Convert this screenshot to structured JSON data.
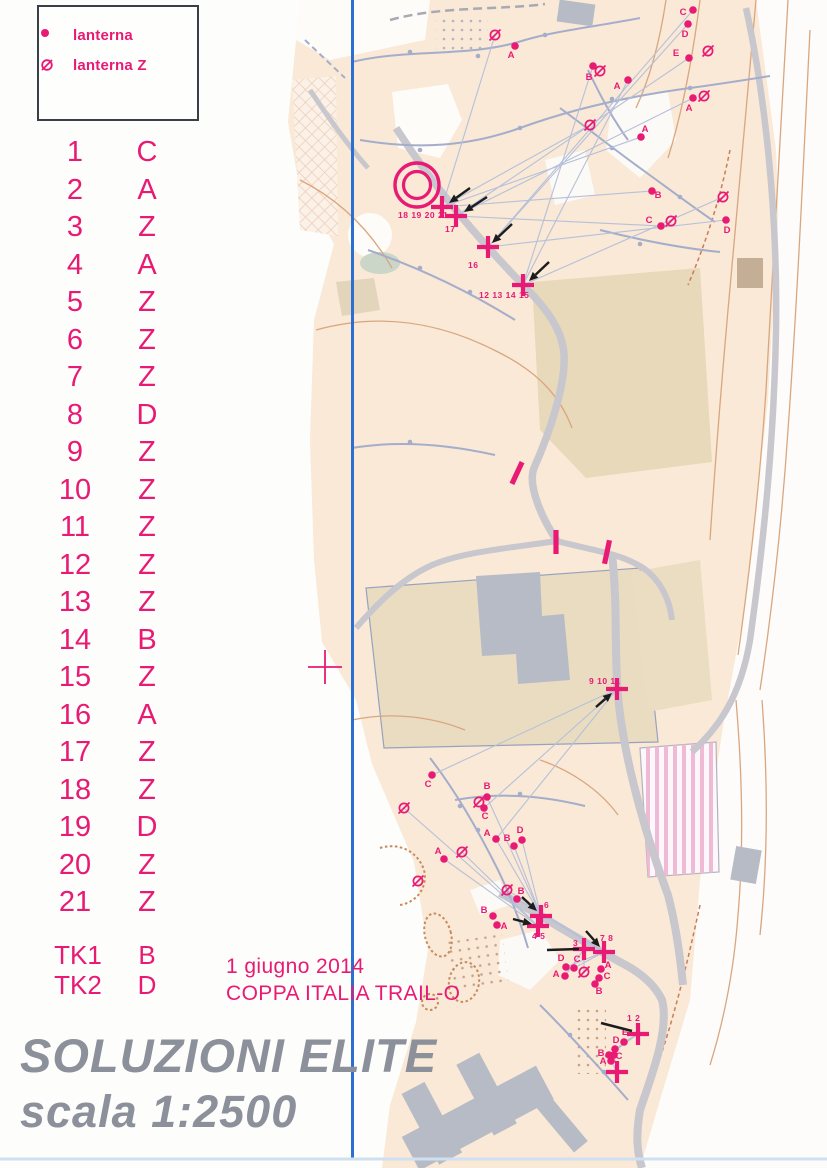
{
  "meta": {
    "event_date": "1 giugno 2014",
    "event_name": "COPPA ITALIA TRAIL-O",
    "title_line1": "SOLUZIONI ELITE",
    "title_line2": "scala 1:2500"
  },
  "colors": {
    "magenta_overprint": "#e81a74",
    "title_gray": "#8b909a",
    "fold_line_blue": "#2b6fd0",
    "map_cream": "#f9e9d6",
    "contour_brown": "#d9a67f",
    "trail_bluegray": "#a4adcb",
    "road_gray": "#c7c7cd",
    "building_gray": "#b6bbc6"
  },
  "legend": {
    "items": [
      {
        "symbol": "lanterna-dot",
        "label": "lanterna"
      },
      {
        "symbol": "lanterna-z",
        "label": "lanterna Z"
      }
    ]
  },
  "solutions": {
    "controls": [
      {
        "n": "1",
        "a": "C"
      },
      {
        "n": "2",
        "a": "A"
      },
      {
        "n": "3",
        "a": "Z"
      },
      {
        "n": "4",
        "a": "A"
      },
      {
        "n": "5",
        "a": "Z"
      },
      {
        "n": "6",
        "a": "Z"
      },
      {
        "n": "7",
        "a": "Z"
      },
      {
        "n": "8",
        "a": "D"
      },
      {
        "n": "9",
        "a": "Z"
      },
      {
        "n": "10",
        "a": "Z"
      },
      {
        "n": "11",
        "a": "Z"
      },
      {
        "n": "12",
        "a": "Z"
      },
      {
        "n": "13",
        "a": "Z"
      },
      {
        "n": "14",
        "a": "B"
      },
      {
        "n": "15",
        "a": "Z"
      },
      {
        "n": "16",
        "a": "A"
      },
      {
        "n": "17",
        "a": "Z"
      },
      {
        "n": "18",
        "a": "Z"
      },
      {
        "n": "19",
        "a": "D"
      },
      {
        "n": "20",
        "a": "Z"
      },
      {
        "n": "21",
        "a": "Z"
      }
    ],
    "timed": [
      {
        "n": "TK1",
        "a": "B"
      },
      {
        "n": "TK2",
        "a": "D"
      }
    ]
  },
  "map_overlay": {
    "start_circle": {
      "x": 417,
      "y": 185,
      "r_outer": 22,
      "r_inner": 13.5
    },
    "register_cross": {
      "x": 325,
      "y": 667
    },
    "crosses": [
      {
        "x": 442,
        "y": 207,
        "label": "18 19 20 21",
        "lx": 398,
        "ly": 218
      },
      {
        "x": 456,
        "y": 216,
        "label": "17",
        "lx": 445,
        "ly": 232
      },
      {
        "x": 488,
        "y": 247,
        "label": "16",
        "lx": 468,
        "ly": 268
      },
      {
        "x": 523,
        "y": 285,
        "label": "12 13 14 15",
        "lx": 479,
        "ly": 298
      },
      {
        "x": 617,
        "y": 689,
        "label": "9 10 11",
        "lx": 589,
        "ly": 684
      },
      {
        "x": 541,
        "y": 916,
        "label": "6",
        "lx": 544,
        "ly": 908
      },
      {
        "x": 538,
        "y": 926,
        "label": "4 5",
        "lx": 532,
        "ly": 939
      },
      {
        "x": 584,
        "y": 949,
        "label": "3",
        "lx": 573,
        "ly": 946
      },
      {
        "x": 604,
        "y": 952,
        "label": "7 8",
        "lx": 600,
        "ly": 941
      },
      {
        "x": 638,
        "y": 1034,
        "label": "1 2",
        "lx": 627,
        "ly": 1021
      },
      {
        "x": 617,
        "y": 1072,
        "label": ""
      }
    ],
    "points": [
      {
        "x": 693,
        "y": 10,
        "l": "C",
        "dx": -10,
        "dy": 5
      },
      {
        "x": 688,
        "y": 24,
        "l": "D",
        "dx": -3,
        "dy": 13
      },
      {
        "x": 689,
        "y": 58,
        "l": "E",
        "dx": -13,
        "dy": -2,
        "zx": 708,
        "zy": 51
      },
      {
        "x": 593,
        "y": 66,
        "l": "B",
        "dx": -4,
        "dy": 14,
        "zx": 600,
        "zy": 71
      },
      {
        "x": 628,
        "y": 80,
        "l": "A",
        "dx": -11,
        "dy": 9
      },
      {
        "x": 693,
        "y": 98,
        "l": "A",
        "dx": -4,
        "dy": 13,
        "zx": 704,
        "zy": 96
      },
      {
        "x": 641,
        "y": 137,
        "l": "A",
        "dx": 4,
        "dy": -5
      },
      {
        "x": 515,
        "y": 46,
        "l": "A",
        "dx": -4,
        "dy": 12
      },
      {
        "x": 652,
        "y": 191,
        "l": "B",
        "dx": 6,
        "dy": 7
      },
      {
        "x": 661,
        "y": 226,
        "l": "C",
        "dx": -12,
        "dy": -3,
        "zx": 671,
        "zy": 221
      },
      {
        "x": 726,
        "y": 220,
        "l": "D",
        "dx": 1,
        "dy": 13
      },
      {
        "x": 432,
        "y": 775,
        "l": "C",
        "dx": -4,
        "dy": 12
      },
      {
        "x": 487,
        "y": 797,
        "l": "B",
        "dx": 0,
        "dy": -8
      },
      {
        "x": 484,
        "y": 808,
        "l": "C",
        "dx": 1,
        "dy": 11,
        "zx": 479,
        "zy": 802
      },
      {
        "x": 496,
        "y": 839,
        "l": "A",
        "dx": -9,
        "dy": -3
      },
      {
        "x": 522,
        "y": 840,
        "l": "D",
        "dx": -2,
        "dy": -7
      },
      {
        "x": 514,
        "y": 846,
        "l": "B",
        "dx": -7,
        "dy": -5
      },
      {
        "x": 444,
        "y": 859,
        "l": "A",
        "dx": -6,
        "dy": -5
      },
      {
        "x": 517,
        "y": 899,
        "l": "B",
        "dx": 4,
        "dy": -5
      },
      {
        "x": 493,
        "y": 916,
        "l": "B",
        "dx": -9,
        "dy": -3
      },
      {
        "x": 497,
        "y": 925,
        "l": "A",
        "dx": 7,
        "dy": 4
      },
      {
        "x": 566,
        "y": 967,
        "l": "D",
        "dx": -5,
        "dy": -6
      },
      {
        "x": 574,
        "y": 968,
        "l": "C",
        "dx": 3,
        "dy": -6
      },
      {
        "x": 565,
        "y": 976,
        "l": "A",
        "dx": -9,
        "dy": 1
      },
      {
        "x": 601,
        "y": 969,
        "l": "A",
        "dx": 7,
        "dy": -1
      },
      {
        "x": 599,
        "y": 978,
        "l": "C",
        "dx": 8,
        "dy": 1
      },
      {
        "x": 595,
        "y": 984,
        "l": "B",
        "dx": 4,
        "dy": 10
      },
      {
        "x": 624,
        "y": 1042,
        "l": "E",
        "dx": 1,
        "dy": -7
      },
      {
        "x": 615,
        "y": 1049,
        "l": "D",
        "dx": 1,
        "dy": -6
      },
      {
        "x": 609,
        "y": 1055,
        "l": "B",
        "dx": -8,
        "dy": 1
      },
      {
        "x": 614,
        "y": 1055,
        "l": "C",
        "dx": 5,
        "dy": 4
      },
      {
        "x": 611,
        "y": 1061,
        "l": "A",
        "dx": -8,
        "dy": 3
      }
    ],
    "z_symbols": [
      {
        "x": 495,
        "y": 35
      },
      {
        "x": 590,
        "y": 125
      },
      {
        "x": 723,
        "y": 197
      },
      {
        "x": 404,
        "y": 808
      },
      {
        "x": 462,
        "y": 852
      },
      {
        "x": 418,
        "y": 881
      },
      {
        "x": 507,
        "y": 890
      },
      {
        "x": 584,
        "y": 972
      }
    ],
    "bars": [
      {
        "x": 517,
        "y": 473,
        "r": 25
      },
      {
        "x": 556,
        "y": 542,
        "r": 0
      },
      {
        "x": 607,
        "y": 552,
        "r": 12
      }
    ],
    "sightlines": [
      [
        442,
        207,
        641,
        137
      ],
      [
        442,
        207,
        652,
        191
      ],
      [
        442,
        207,
        590,
        125
      ],
      [
        442,
        207,
        495,
        35
      ],
      [
        456,
        216,
        693,
        98
      ],
      [
        456,
        216,
        689,
        58
      ],
      [
        456,
        216,
        661,
        226
      ],
      [
        488,
        247,
        688,
        24
      ],
      [
        488,
        247,
        693,
        10
      ],
      [
        488,
        247,
        726,
        220
      ],
      [
        523,
        285,
        723,
        197
      ],
      [
        523,
        285,
        593,
        66
      ],
      [
        523,
        285,
        628,
        80
      ],
      [
        617,
        689,
        432,
        775
      ],
      [
        617,
        689,
        484,
        808
      ],
      [
        617,
        689,
        496,
        839
      ],
      [
        541,
        916,
        496,
        839
      ],
      [
        541,
        916,
        514,
        846
      ],
      [
        541,
        916,
        522,
        840
      ],
      [
        541,
        916,
        487,
        797
      ],
      [
        538,
        926,
        444,
        859
      ],
      [
        538,
        926,
        462,
        852
      ],
      [
        538,
        926,
        404,
        808
      ],
      [
        604,
        952,
        517,
        899
      ],
      [
        604,
        952,
        507,
        890
      ],
      [
        604,
        952,
        566,
        967
      ],
      [
        604,
        952,
        574,
        968
      ],
      [
        584,
        949,
        565,
        976
      ],
      [
        584,
        949,
        584,
        972
      ],
      [
        638,
        1034,
        624,
        1042
      ],
      [
        638,
        1034,
        615,
        1049
      ],
      [
        638,
        1034,
        609,
        1055
      ],
      [
        617,
        1072,
        611,
        1061
      ],
      [
        617,
        1072,
        614,
        1055
      ]
    ],
    "arrows": [
      [
        470,
        188,
        449,
        203
      ],
      [
        487,
        197,
        464,
        212
      ],
      [
        512,
        224,
        492,
        243
      ],
      [
        549,
        262,
        529,
        281
      ],
      [
        596,
        707,
        612,
        693
      ],
      [
        522,
        897,
        537,
        911
      ],
      [
        513,
        919,
        532,
        924
      ],
      [
        586,
        931,
        600,
        947
      ]
    ],
    "pointer_lines": [
      [
        547,
        950,
        579,
        949
      ],
      [
        601,
        1023,
        632,
        1031
      ]
    ]
  }
}
